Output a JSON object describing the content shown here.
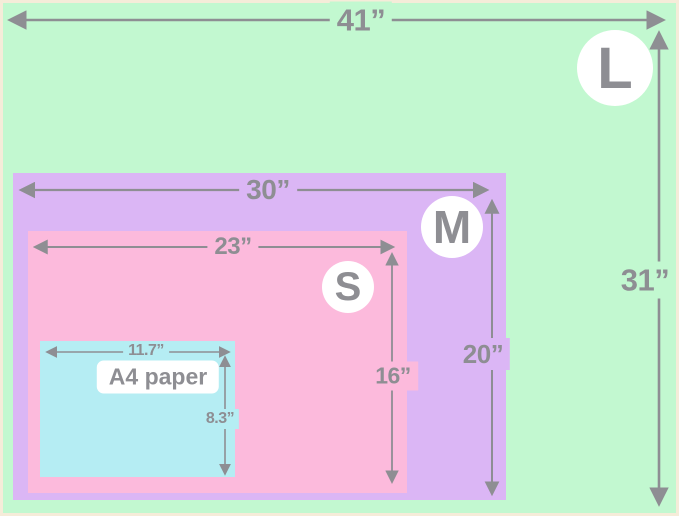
{
  "colors": {
    "border": "#f5ecd9",
    "arrow": "#8e8e93",
    "text": "#8e8e93",
    "badge_bg": "#ffffff"
  },
  "sizes": [
    {
      "name": "L",
      "width_label": "41”",
      "height_label": "31”",
      "color": "#c2f8d0"
    },
    {
      "name": "M",
      "width_label": "30”",
      "height_label": "20”",
      "color": "#dbb6f5"
    },
    {
      "name": "S",
      "width_label": "23”",
      "height_label": "16”",
      "color": "#fcbadc"
    },
    {
      "name": "A4 paper",
      "width_label": "11.7”",
      "height_label": "8.3”",
      "color": "#b5edf3"
    }
  ],
  "chart_data": {
    "type": "table",
    "title": "Blanket size comparison (nested rectangles)",
    "columns": [
      "size",
      "width_inches",
      "height_inches"
    ],
    "rows": [
      [
        "L",
        41,
        31
      ],
      [
        "M",
        30,
        20
      ],
      [
        "S",
        23,
        16
      ],
      [
        "A4 paper",
        11.7,
        8.3
      ]
    ]
  }
}
